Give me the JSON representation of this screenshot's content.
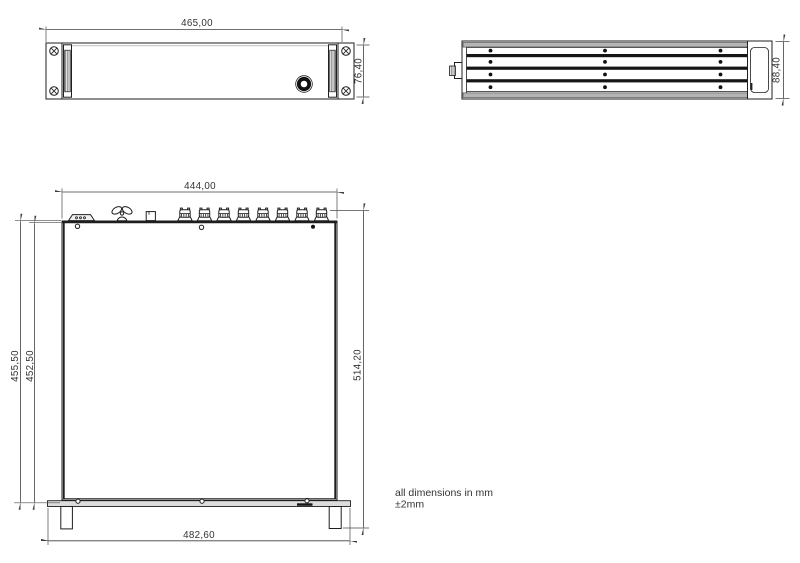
{
  "front": {
    "width": "465,00",
    "height": "76,40"
  },
  "side": {
    "height": "88,40"
  },
  "top": {
    "width": "444,00",
    "height_outer": "455,50",
    "height_inner": "452,50",
    "height_total": "514,20",
    "panel_width": "482,60"
  },
  "note": {
    "line1": "all dimensions in mm",
    "line2": "±2mm"
  },
  "colors": {
    "line": "#1f1f1f",
    "dimension": "#3f3f3f",
    "rail_gray": "#b5b5b5",
    "panel_gray": "#dcdcdc",
    "background": "#ffffff"
  }
}
